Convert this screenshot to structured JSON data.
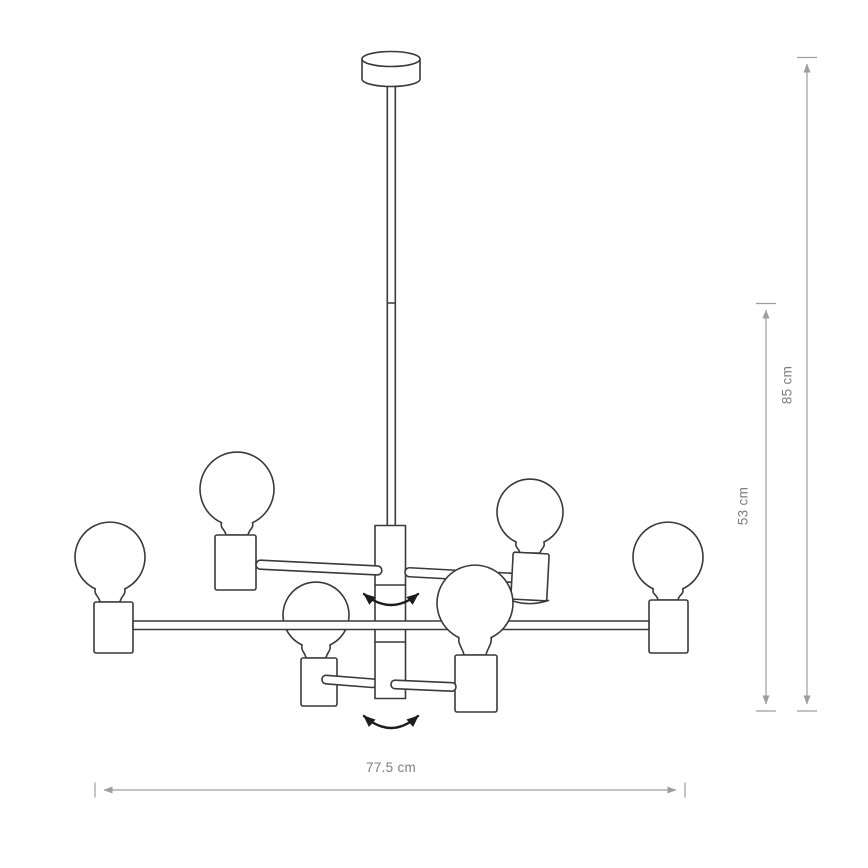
{
  "diagram": {
    "subject": "chandelier-technical-drawing",
    "bulb_count": 6,
    "dimensions": {
      "height_total": {
        "label": "85 cm"
      },
      "height_body": {
        "label": "53 cm"
      },
      "width": {
        "label": "77.5 cm"
      }
    },
    "icons": {
      "rotation_arrow_upper": "curved-double-headed-arrow",
      "rotation_arrow_lower": "curved-double-headed-arrow"
    },
    "colors": {
      "outline": "#3a3a3a",
      "dimension_line": "#9e9e9e",
      "dimension_text": "#7d7d7d",
      "rotation_arrow": "#1c1c1c",
      "background": "#ffffff"
    }
  }
}
